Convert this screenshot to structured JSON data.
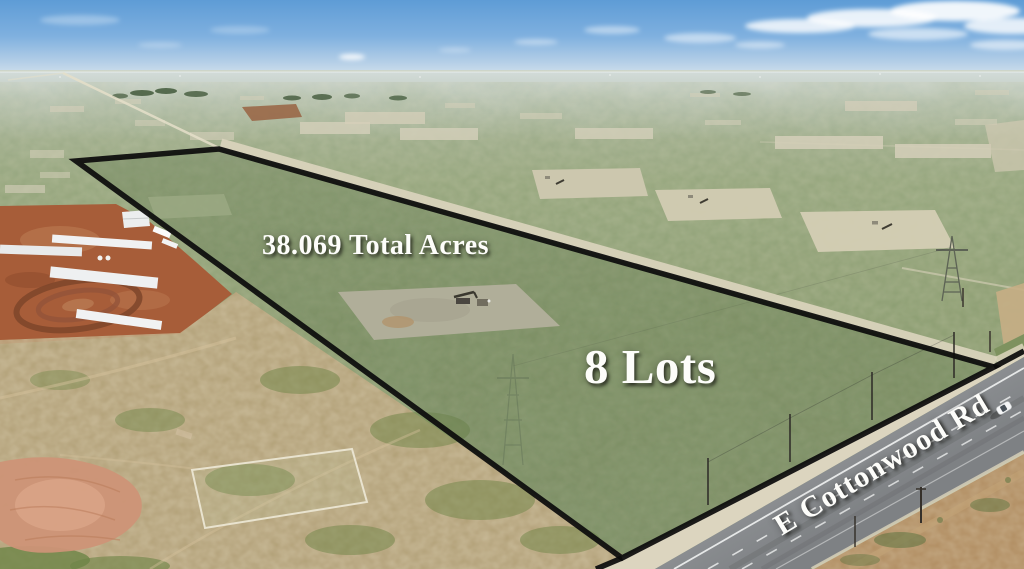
{
  "image_type": "aerial-real-estate-listing-photo",
  "labels": {
    "total_acres": "38.069 Total Acres",
    "lots": "8 Lots",
    "road_name": "E Cottonwood Rd"
  },
  "scene": {
    "parcel": {
      "shape": "long diagonal parallelogram outlined in black with translucent green tint",
      "outline_color": "#0c0c0c",
      "tint_color": "rgba(70,95,55,0.25)"
    },
    "objects": [
      "pumpjack-icon",
      "oil-pad",
      "transmission-tower-icon",
      "farm-buildings",
      "cattle-pen-rings",
      "paved-road",
      "car-icon",
      "utility-poles",
      "caliche-road-strip",
      "clouds"
    ],
    "colors": {
      "sky_top": "#5e9cd6",
      "sky_horizon": "#dce7ee",
      "scrub_green": "#8fa173",
      "caliche_pad": "#d5cfba",
      "farm_dirt": "#a75d39",
      "foreground_tan": "#b7a078",
      "pink_dirt": "#cd9377",
      "road_asphalt": "#8a8d90",
      "label_text": "#ffffff"
    }
  }
}
